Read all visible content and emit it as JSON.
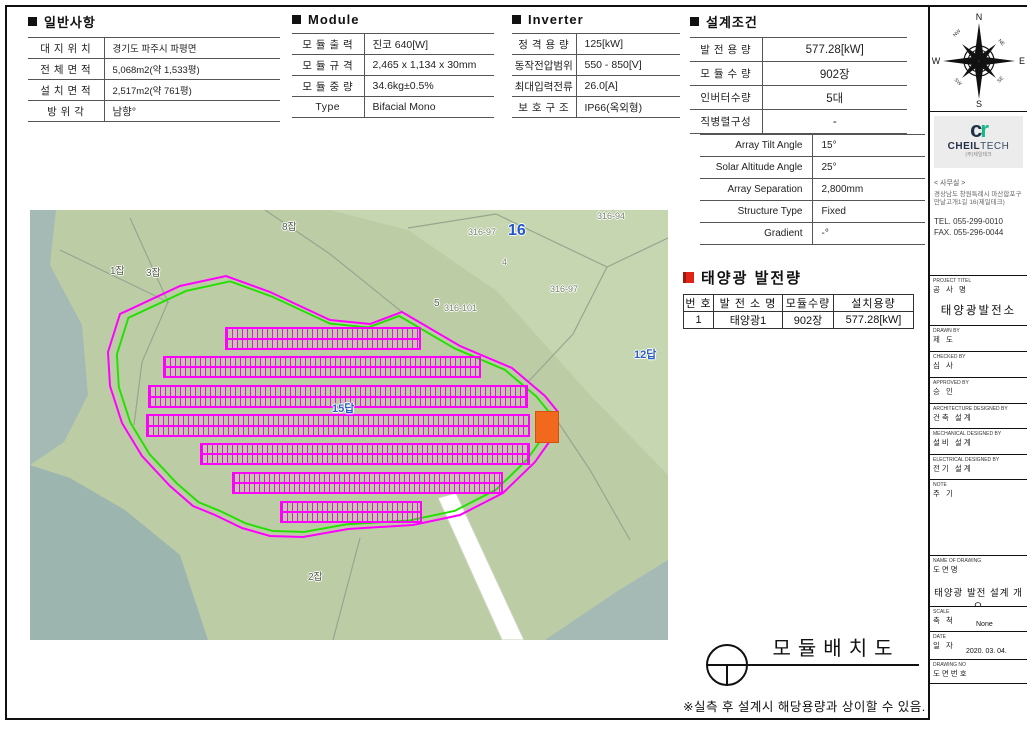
{
  "general": {
    "title": "일반사항",
    "rows": [
      {
        "label": "대 지 위 치",
        "value": "경기도 파주시 파평면"
      },
      {
        "label": "전 체 면 적",
        "value": "5,068m2(약 1,533평)"
      },
      {
        "label": "설 치 면 적",
        "value": "2,517m2(약 761평)"
      },
      {
        "label": "방  위  각",
        "value": "남향°"
      }
    ]
  },
  "module": {
    "title": "Module",
    "rows": [
      {
        "label": "모 듈 출 력",
        "value": "진코 640[W]"
      },
      {
        "label": "모 듈 규 격",
        "value": "2,465 x 1,134 x 30mm"
      },
      {
        "label": "모 듈 중 량",
        "value": "34.6kg±0.5%"
      },
      {
        "label": "Type",
        "value": "Bifacial Mono"
      }
    ]
  },
  "inverter": {
    "title": "Inverter",
    "rows": [
      {
        "label": "정 격 용 량",
        "value": "125[kW]"
      },
      {
        "label": "동작전압범위",
        "value": "550 - 850[V]"
      },
      {
        "label": "최대입력전류",
        "value": "26.0[A]"
      },
      {
        "label": "보 호 구 조",
        "value": "IP66(옥외형)"
      }
    ]
  },
  "design": {
    "title": "설계조건",
    "rows": [
      {
        "label": "발 전 용 량",
        "value": "577.28[kW]"
      },
      {
        "label": "모 듈 수 량",
        "value": "902장"
      },
      {
        "label": "인버터수량",
        "value": "5대"
      },
      {
        "label": "직병렬구성",
        "value": "-"
      }
    ],
    "sub_rows": [
      {
        "label": "Array Tilt Angle",
        "value": "15°"
      },
      {
        "label": "Solar Altitude Angle",
        "value": "25°"
      },
      {
        "label": "Array Separation",
        "value": "2,800mm"
      },
      {
        "label": "Structure Type",
        "value": "Fixed"
      },
      {
        "label": "Gradient",
        "value": "-°"
      }
    ]
  },
  "generation": {
    "title": "태양광 발전량",
    "headers": [
      "번 호",
      "발 전 소 명",
      "모듈수량",
      "설치용량"
    ],
    "row": [
      "1",
      "태양광1",
      "902장",
      "577.28[kW]"
    ]
  },
  "footer": {
    "title": "모듈배치도",
    "note": "※실측 후 설계시 해당용량과 상이할 수 있음."
  },
  "map": {
    "labels": [
      {
        "text": "8잡",
        "x": 252,
        "y": 8,
        "cls": "lbl-dark"
      },
      {
        "text": "1잡",
        "x": 80,
        "y": 52,
        "cls": "lbl-dark"
      },
      {
        "text": "3잡",
        "x": 116,
        "y": 54,
        "cls": "lbl-dark"
      },
      {
        "text": "316-97",
        "x": 438,
        "y": 17,
        "cls": "lbl-gray"
      },
      {
        "text": "16",
        "x": 478,
        "y": 12,
        "cls": "lbl-blue-big"
      },
      {
        "text": "316-94",
        "x": 567,
        "y": 1,
        "cls": "lbl-gray"
      },
      {
        "text": "4",
        "x": 472,
        "y": 47,
        "cls": "lbl-gray"
      },
      {
        "text": "5",
        "x": 404,
        "y": 88,
        "cls": "lbl-dark"
      },
      {
        "text": "316-101",
        "x": 414,
        "y": 93,
        "cls": "lbl-gray"
      },
      {
        "text": "316-97",
        "x": 520,
        "y": 74,
        "cls": "lbl-gray"
      },
      {
        "text": "12답",
        "x": 604,
        "y": 136,
        "cls": "lbl-blue"
      },
      {
        "text": "15답",
        "x": 302,
        "y": 190,
        "cls": "lbl-blue"
      },
      {
        "text": "2잡",
        "x": 278,
        "y": 358,
        "cls": "lbl-dark"
      }
    ],
    "panel_bands": [
      {
        "x": 195,
        "y": 117,
        "w": 196,
        "h": 23
      },
      {
        "x": 133,
        "y": 146,
        "w": 318,
        "h": 22
      },
      {
        "x": 118,
        "y": 175,
        "w": 380,
        "h": 23
      },
      {
        "x": 116,
        "y": 204,
        "w": 384,
        "h": 23
      },
      {
        "x": 170,
        "y": 233,
        "w": 330,
        "h": 22
      },
      {
        "x": 202,
        "y": 262,
        "w": 271,
        "h": 22
      },
      {
        "x": 250,
        "y": 291,
        "w": 142,
        "h": 22
      }
    ],
    "colors": {
      "boundary_outer": "#ff00ff",
      "boundary_inner": "#22e000",
      "panel": "#ff00ff",
      "equipment_pad": "#f2691d",
      "terrain": "#bccda6",
      "terrain_light": "#c6d6b0",
      "water": "#a5bab4",
      "road": "#ffffff"
    }
  },
  "sidebar": {
    "compass": {
      "n": "N",
      "e": "E",
      "s": "S",
      "w": "W",
      "ne": "NE",
      "nw": "NW",
      "se": "SE",
      "sw": "SW"
    },
    "company": {
      "logo_c": "c",
      "logo_r": "r",
      "name_bold": "CHEIL",
      "name_light": "TECH",
      "name_sub": "(주)제일테크",
      "office_label": "< 사무실 >",
      "address1": "경상남도 창원특례시 마산합포구",
      "address2": "만날고개1길 16(제일테크)",
      "tel": "TEL. 055-299-0010",
      "fax": "FAX. 055-296-0044"
    },
    "title_block": [
      {
        "en": "PROJECT TITEL",
        "kr": "공 사 명",
        "content": "태양광발전소"
      },
      {
        "en": "DRAWN BY",
        "kr": "제  도",
        "content": ""
      },
      {
        "en": "CHECKED BY",
        "kr": "심  사",
        "content": ""
      },
      {
        "en": "APPROVED BY",
        "kr": "승  인",
        "content": ""
      },
      {
        "en": "ARCHITECTURE DESIGNED BY",
        "kr": "건축 설계",
        "content": ""
      },
      {
        "en": "MECHANICAL DESIGNED BY",
        "kr": "설비 설계",
        "content": ""
      },
      {
        "en": "ELECTRICAL DESIGNED BY",
        "kr": "전기 설계",
        "content": ""
      },
      {
        "en": "NOTE",
        "kr": "주  기",
        "content": ""
      },
      {
        "en": "NAME OF DRAWING",
        "kr": "도면명",
        "content": "태양광 발전 설계 개요"
      },
      {
        "en": "SCALE",
        "kr": "축  척",
        "content": "None"
      },
      {
        "en": "DATE",
        "kr": "일  자",
        "content": "2020. 03. 04."
      },
      {
        "en": "DRAWING NO",
        "kr": "도면번호",
        "content": ""
      }
    ]
  }
}
